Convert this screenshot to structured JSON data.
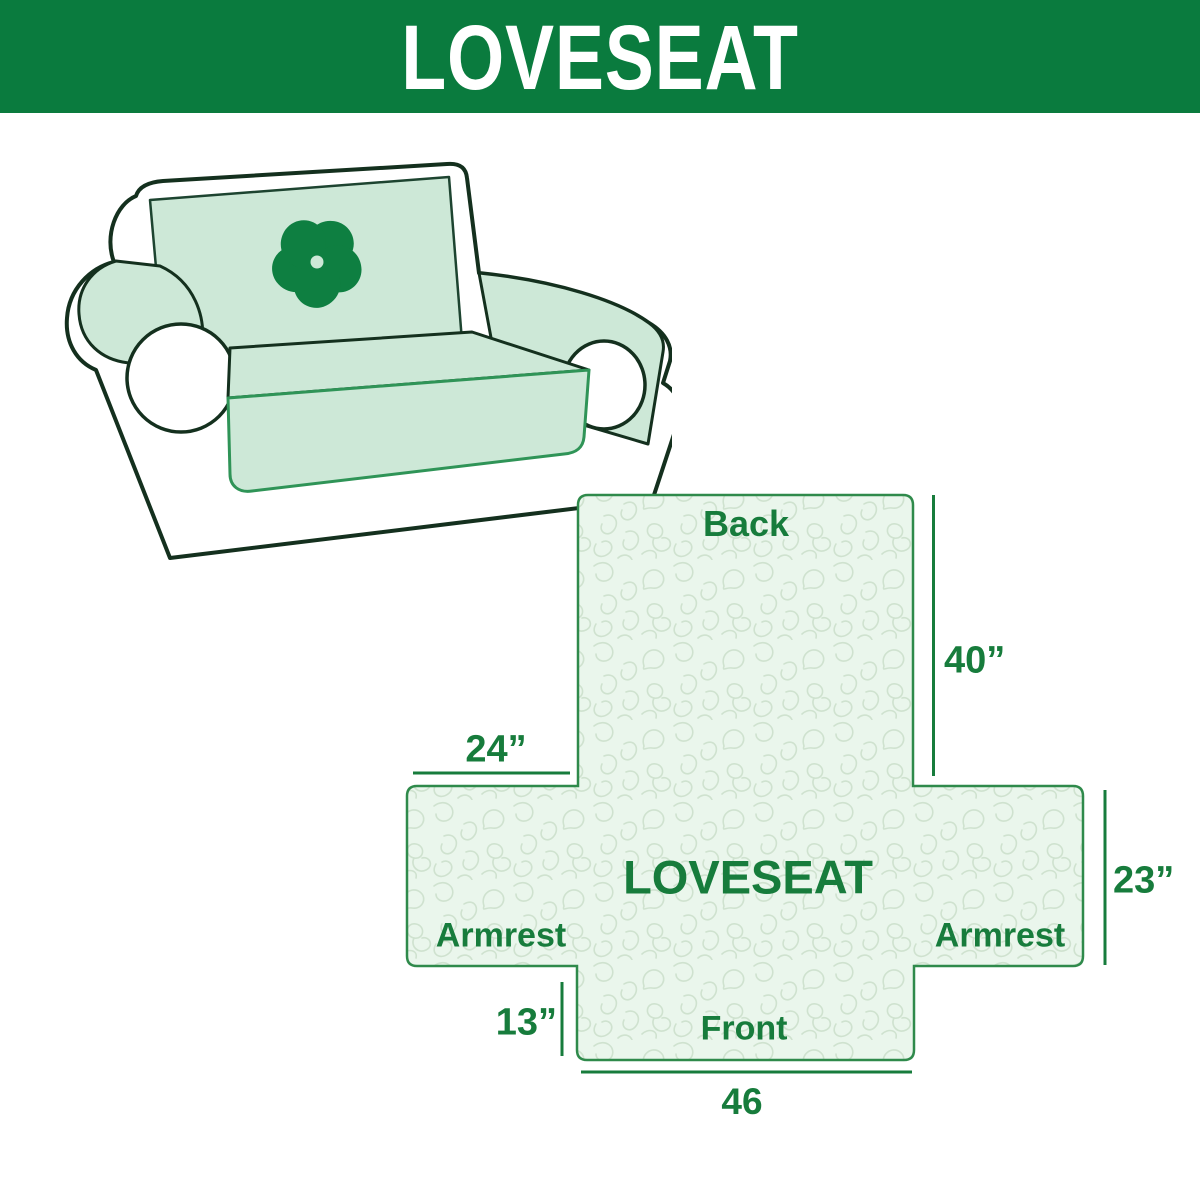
{
  "header": {
    "title": "LOVESEAT",
    "background": "#0a7b3e",
    "text_color": "#ffffff"
  },
  "illustration": {
    "logo_icon": "pinwheel-icon"
  },
  "diagram": {
    "center_label": "LOVESEAT",
    "section_labels": {
      "back": "Back",
      "front": "Front",
      "armrest_left": "Armrest",
      "armrest_right": "Armrest"
    },
    "dimensions": {
      "back": "40”",
      "armrest": "24”",
      "side": "23”",
      "front_skirt": "13”",
      "front_width": "46"
    }
  },
  "colors": {
    "header_green": "#0a7b3e",
    "label_green": "#177c3c",
    "diagram_border_green": "#2f8a4b",
    "diagram_fill": "#eaf6ec",
    "pattern_line": "#cfe2cf",
    "sofa_outline": "#14301e",
    "cover_mint": "#cde8d7",
    "skirt_edge_green": "#2f9457",
    "logo_green": "#0e7f41"
  }
}
